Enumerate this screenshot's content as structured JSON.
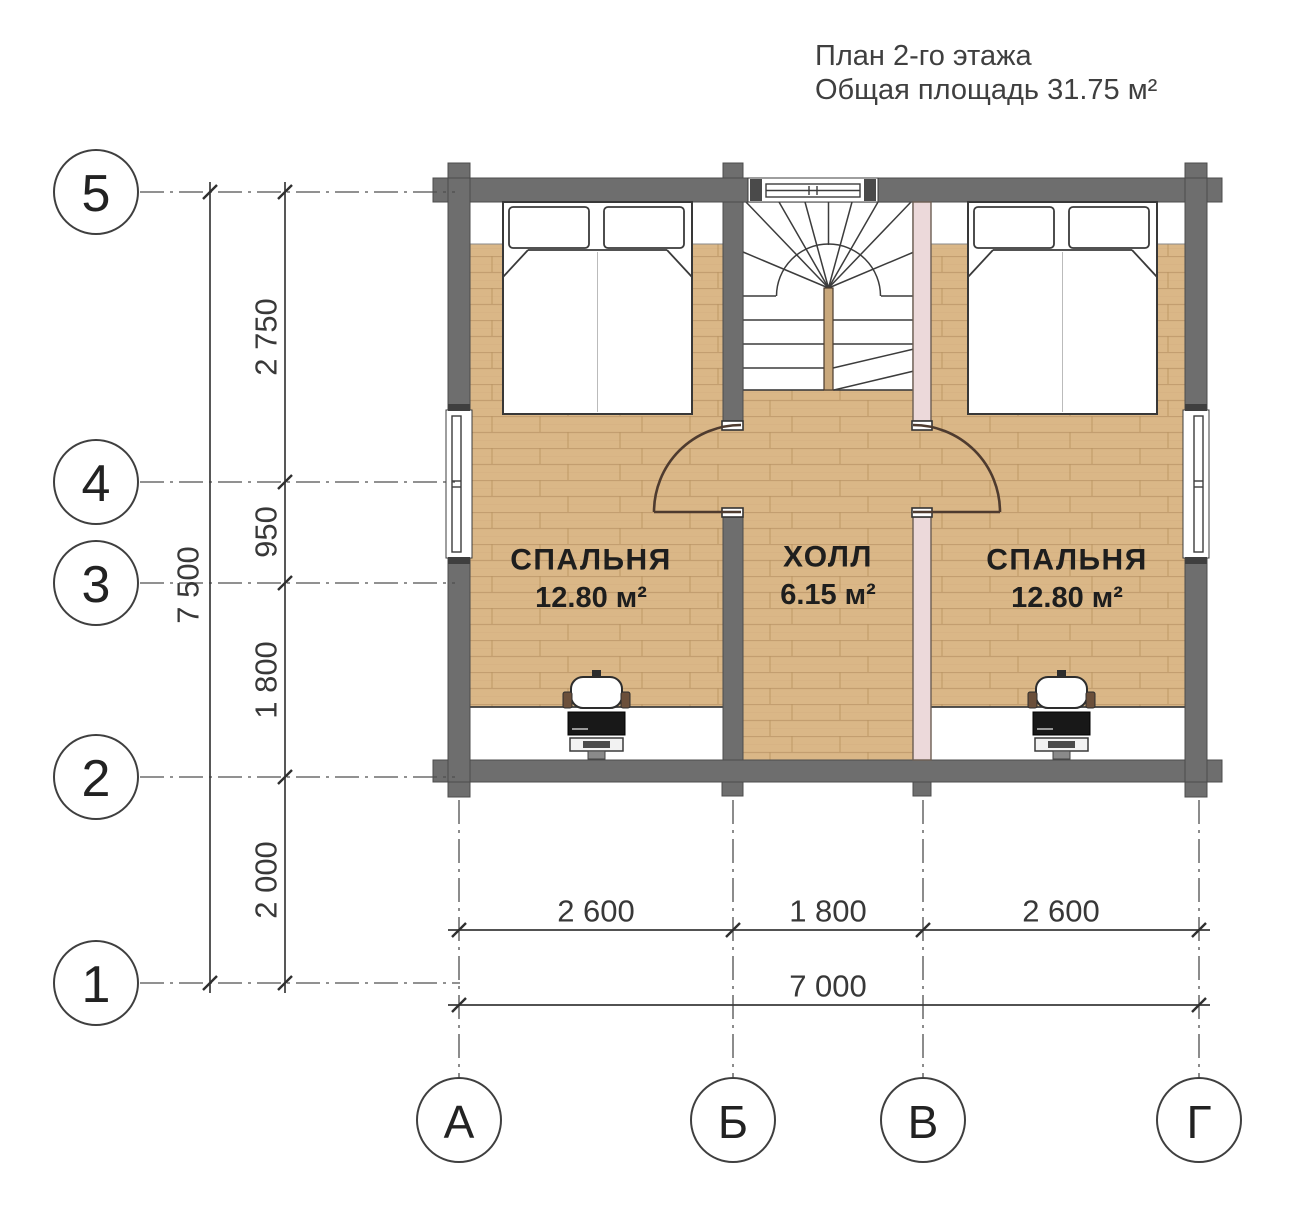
{
  "title": {
    "line1": "План 2-го этажа",
    "line2": "Общая площадь 31.75 м²"
  },
  "grid": {
    "rows": [
      {
        "label": "5"
      },
      {
        "label": "4"
      },
      {
        "label": "3"
      },
      {
        "label": "2"
      },
      {
        "label": "1"
      }
    ],
    "cols": [
      {
        "label": "А"
      },
      {
        "label": "Б"
      },
      {
        "label": "В"
      },
      {
        "label": "Г"
      }
    ]
  },
  "dimensions": {
    "vertical": {
      "segments": [
        "2 750",
        "950",
        "1 800",
        "2 000"
      ],
      "total": "7 500"
    },
    "horizontal": {
      "segments": [
        "2 600",
        "1 800",
        "2 600"
      ],
      "total": "7 000"
    }
  },
  "rooms": {
    "bedroom_left": {
      "name": "СПАЛЬНЯ",
      "area": "12.80 м²"
    },
    "hall": {
      "name": "ХОЛЛ",
      "area": "6.15 м²"
    },
    "bedroom_right": {
      "name": "СПАЛЬНЯ",
      "area": "12.80 м²"
    }
  },
  "colors": {
    "wall_gray": "#6e6e6e",
    "partition_pink": "#ecd9da",
    "floor_wood": "#dab787",
    "stair_divider": "#c9a87c",
    "background": "#ffffff"
  }
}
